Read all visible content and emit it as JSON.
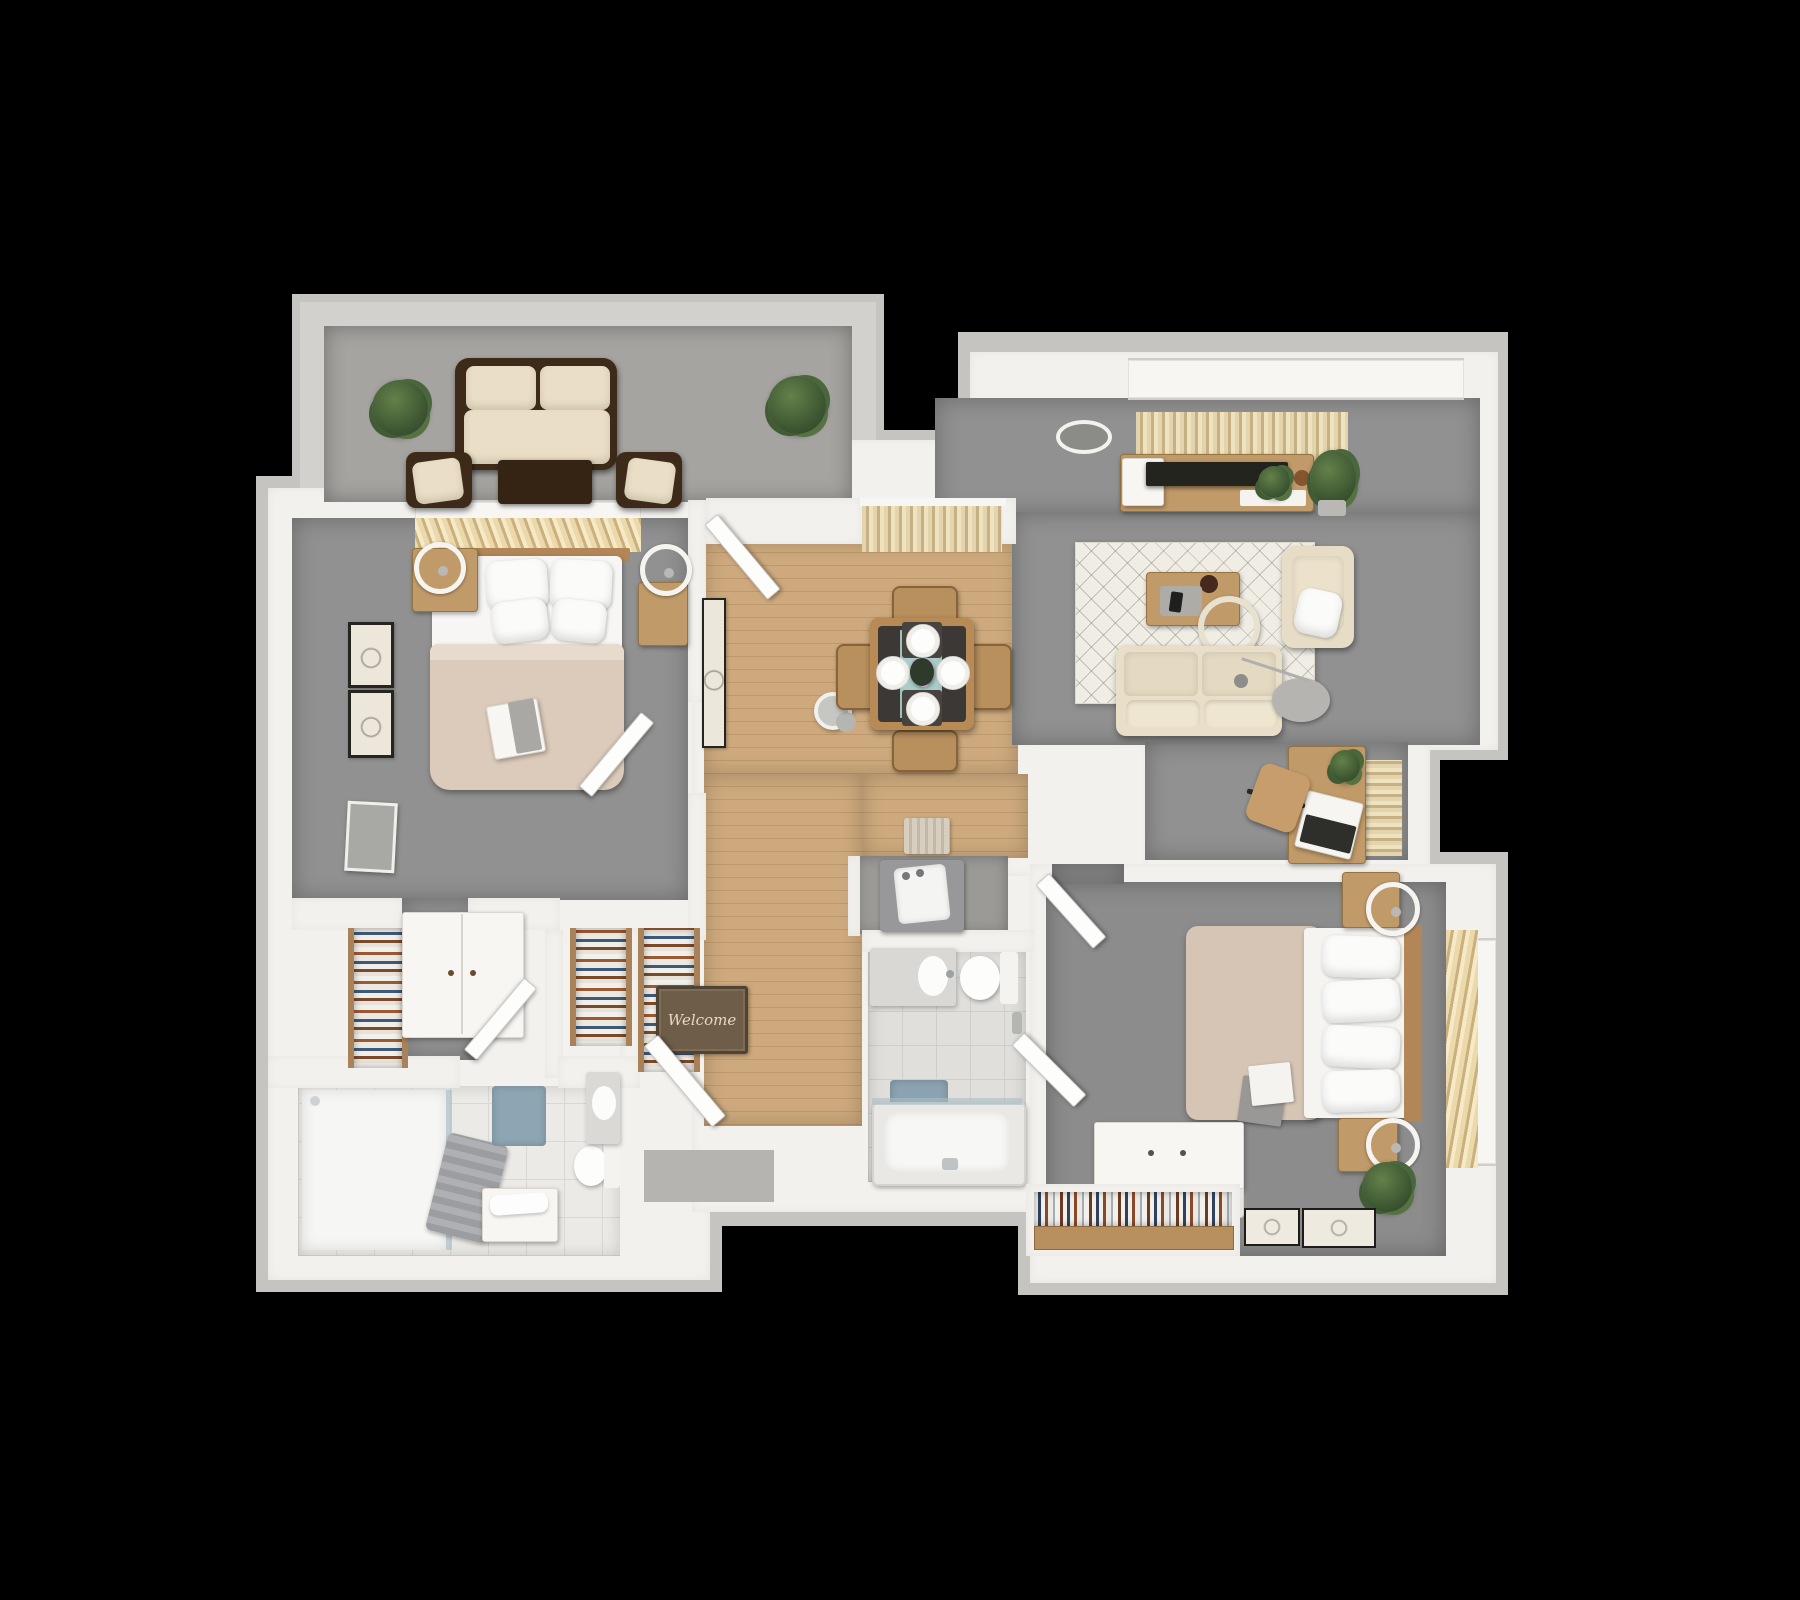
{
  "meta": {
    "title": "2 Bedroom 2 Bath Apartment - 3D Top-Down Floor Plan Render",
    "background": "#000000"
  },
  "palette": {
    "outer_wall": "#c6c4c1",
    "inner_wall": "#f3f1ed",
    "carpet": "#919191",
    "balcony_concrete": "#a5a4a1",
    "wood_floor": "#c9a478",
    "tile_floor": "#ebeae6",
    "rug_cream": "#f0ede5",
    "sofa_cream": "#e9dfc8",
    "dark_wood": "#3e2a19",
    "furniture_wood": "#c09a68",
    "duvet_beige": "#d6c5b5",
    "accent_teal": "#a9cdc8",
    "bath_mat_blue": "#8ba2b0",
    "plant_green": "#3c5531"
  },
  "entry": {
    "welcome_mat_text": "Welcome"
  },
  "rooms": [
    {
      "name": "balcony",
      "floor": "concrete",
      "furniture": [
        "outdoor-loveseat",
        "outdoor-chair-left",
        "outdoor-chair-right",
        "outdoor-coffee-table",
        "potted-plant-left",
        "potted-plant-right"
      ]
    },
    {
      "name": "master-bedroom",
      "floor": "carpet",
      "furniture": [
        "queen-bed",
        "headboard",
        "window-blinds",
        "nightstand-left",
        "nightstand-right",
        "ring-lamp-left",
        "ring-lamp-right",
        "wall-art-top",
        "wall-art-bottom",
        "leaning-mirror",
        "book-on-bed",
        "bedroom-door"
      ]
    },
    {
      "name": "master-closet",
      "floor": "carpet",
      "furniture": [
        "linen-shelf-left",
        "linen-shelf-middle",
        "linen-shelf-right",
        "white-dresser",
        "closet-door"
      ]
    },
    {
      "name": "master-bathroom",
      "floor": "tile",
      "furniture": [
        "walk-in-shower",
        "shower-towels",
        "towel-bench",
        "bath-mat",
        "toilet",
        "sink-vanity",
        "bathroom-door"
      ]
    },
    {
      "name": "dining-area",
      "floor": "wood",
      "furniture": [
        "dining-table",
        "table-runner",
        "flower-vase",
        "place-setting-top",
        "place-setting-bottom",
        "place-setting-left",
        "place-setting-right",
        "dining-chair-top",
        "dining-chair-bottom",
        "dining-chair-left",
        "dining-chair-right",
        "window-curtains",
        "wall-art",
        "pendant-light",
        "front-door"
      ]
    },
    {
      "name": "living-room",
      "floor": "carpet",
      "furniture": [
        "sofa",
        "area-rug",
        "coffee-table",
        "decor-tray",
        "remote",
        "ring-floor-lamp",
        "arc-lamp",
        "tv-console",
        "tv",
        "media-shelf",
        "console-plant",
        "tall-plant",
        "armchair",
        "throw-pillow",
        "window-drapes",
        "ceiling-light",
        "desk",
        "laptop",
        "desk-plant",
        "office-chair",
        "desk-curtains"
      ]
    },
    {
      "name": "hallway-entry",
      "floor": "wood",
      "furniture": [
        "welcome-mat",
        "entry-door",
        "linen-closet-shelf",
        "woven-mat"
      ]
    },
    {
      "name": "laundry-closet",
      "floor": "concrete",
      "furniture": [
        "washer"
      ]
    },
    {
      "name": "second-bathroom",
      "floor": "tile",
      "furniture": [
        "sink-vanity",
        "toilet",
        "towel-ring",
        "bath-mat",
        "bathtub",
        "glass-screen",
        "bathroom-door"
      ]
    },
    {
      "name": "second-bedroom",
      "floor": "carpet",
      "furniture": [
        "full-bed",
        "headboard",
        "window-blinds",
        "nightstand-top",
        "nightstand-bottom",
        "ring-lamp-top",
        "ring-lamp-bottom",
        "white-dresser",
        "closet-bookshelf",
        "potted-plant",
        "floor-frame-small",
        "floor-frame-large",
        "book-on-bed",
        "bedroom-door"
      ]
    }
  ]
}
